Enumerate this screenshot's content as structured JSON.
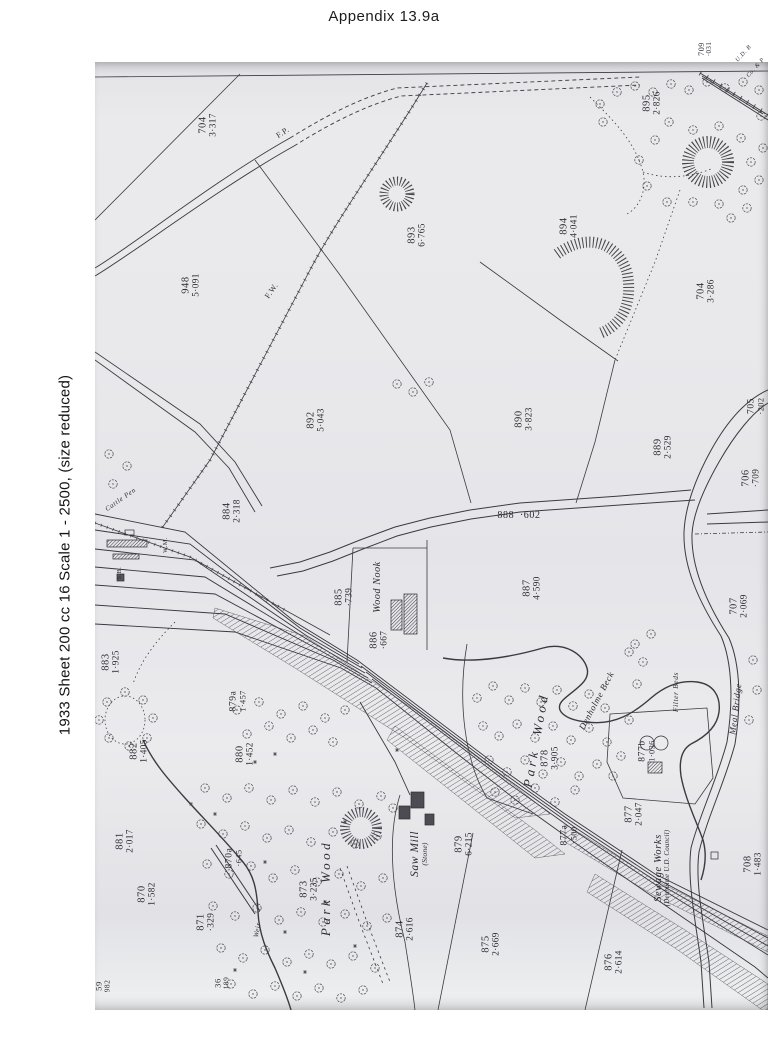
{
  "page": {
    "title": "Appendix  13.9a",
    "caption": "1933 Sheet 200 cc 16 Scale 1 - 2500, (size reduced)"
  },
  "colors": {
    "page_bg": "#ffffff",
    "paper": "#e9e9ec",
    "ink": "#35353b",
    "label_ink": "#2c2c33"
  },
  "map": {
    "parcel_labels": [
      {
        "number": "704",
        "acreage": "3·317",
        "x": 208,
        "y": 125
      },
      {
        "number": "709",
        "acreage": "·031",
        "x": 706,
        "y": 49,
        "size": 8
      },
      {
        "number": "895",
        "acreage": "2·826",
        "x": 652,
        "y": 103
      },
      {
        "number": "948",
        "acreage": "5·091",
        "x": 191,
        "y": 285
      },
      {
        "number": "893",
        "acreage": "6·765",
        "x": 417,
        "y": 235
      },
      {
        "number": "894",
        "acreage": "4·041",
        "x": 569,
        "y": 226
      },
      {
        "number": "704",
        "acreage": "3·286",
        "x": 706,
        "y": 291
      },
      {
        "number": "892",
        "acreage": "5·043",
        "x": 316,
        "y": 420
      },
      {
        "number": "890",
        "acreage": "3·823",
        "x": 524,
        "y": 419
      },
      {
        "number": "889",
        "acreage": "2·529",
        "x": 663,
        "y": 447
      },
      {
        "number": "884",
        "acreage": "2·318",
        "x": 232,
        "y": 511
      },
      {
        "number": "888",
        "acreage": "·602",
        "x": 519,
        "y": 516,
        "rot": 0,
        "inline": true,
        "size": 10
      },
      {
        "number": "887",
        "acreage": "4·590",
        "x": 532,
        "y": 588
      },
      {
        "number": "885",
        "acreage": "·739",
        "x": 344,
        "y": 597
      },
      {
        "number": "886",
        "acreage": "·667",
        "x": 379,
        "y": 640
      },
      {
        "number": "883",
        "acreage": "1·925",
        "x": 111,
        "y": 662
      },
      {
        "number": "879a",
        "acreage": "1·457",
        "x": 239,
        "y": 701,
        "size": 9.5
      },
      {
        "number": "882",
        "acreage": "1·405",
        "x": 139,
        "y": 751
      },
      {
        "number": "880",
        "acreage": "1·452",
        "x": 245,
        "y": 754
      },
      {
        "number": "881",
        "acreage": "2·017",
        "x": 125,
        "y": 841
      },
      {
        "number": "870a",
        "acreage": "·645",
        "x": 235,
        "y": 858,
        "size": 9.5
      },
      {
        "number": "870",
        "acreage": "1·582",
        "x": 147,
        "y": 894
      },
      {
        "number": "871",
        "acreage": "·329",
        "x": 206,
        "y": 922
      },
      {
        "number": "873",
        "acreage": "3·235",
        "x": 309,
        "y": 889
      },
      {
        "number": "874",
        "acreage": "2·616",
        "x": 405,
        "y": 929
      },
      {
        "number": "875",
        "acreage": "2·669",
        "x": 491,
        "y": 944
      },
      {
        "number": "876",
        "acreage": "2·614",
        "x": 614,
        "y": 962
      },
      {
        "number": "879",
        "acreage": "6·215",
        "x": 464,
        "y": 844
      },
      {
        "number": "877",
        "acreage": "2·047",
        "x": 634,
        "y": 814
      },
      {
        "number": "877a",
        "acreage": "·500",
        "x": 570,
        "y": 835,
        "size": 9.5
      },
      {
        "number": "877b",
        "acreage": "1·036",
        "x": 648,
        "y": 751,
        "size": 9.5
      },
      {
        "number": "878",
        "acreage": "3·905",
        "x": 550,
        "y": 758
      },
      {
        "number": "705",
        "acreage": "·202",
        "x": 757,
        "y": 406,
        "size": 9.5
      },
      {
        "number": "706",
        "acreage": "·709",
        "x": 751,
        "y": 478
      },
      {
        "number": "707",
        "acreage": "2·069",
        "x": 739,
        "y": 606
      },
      {
        "number": "708",
        "acreage": "1·483",
        "x": 753,
        "y": 864
      },
      {
        "number": "59",
        "acreage": "982",
        "x": 103,
        "y": 986,
        "size": 8.5
      },
      {
        "number": "36",
        "acreage": "189",
        "x": 222,
        "y": 983,
        "size": 8.5
      }
    ],
    "place_labels": [
      {
        "text": "Wood Nook",
        "x": 378,
        "y": 587,
        "rot": -90,
        "size": 10
      },
      {
        "lines": [
          "Saw Mill",
          "(Stone)"
        ],
        "x": 419,
        "y": 854,
        "rot": -90,
        "size": 11.5
      },
      {
        "text": "Park Wood",
        "x": 326,
        "y": 888,
        "rot": -90,
        "size": 13,
        "spread": true
      },
      {
        "text": "Park Wood",
        "x": 536,
        "y": 740,
        "rot": -80,
        "size": 13,
        "spread": true
      },
      {
        "lines": [
          "Sewage Works",
          "(Denholme U.D. Council)"
        ],
        "x": 662,
        "y": 868,
        "rot": -90,
        "size": 10.5
      },
      {
        "text": "Denholme Beck",
        "x": 597,
        "y": 701,
        "rot": -62,
        "size": 9
      },
      {
        "text": "Filter Beds",
        "x": 676,
        "y": 692,
        "rot": -90,
        "size": 7.5
      },
      {
        "text": "Meal Bridge",
        "x": 736,
        "y": 709,
        "rot": -83,
        "size": 9
      },
      {
        "text": "Cattle Pen",
        "x": 121,
        "y": 500,
        "rot": -35,
        "size": 7
      },
      {
        "text": "Weir",
        "x": 258,
        "y": 930,
        "rot": -80,
        "size": 7
      },
      {
        "text": "F.W.",
        "x": 272,
        "y": 291,
        "rot": -55,
        "size": 8,
        "italic": false
      },
      {
        "text": "F.P.",
        "x": 283,
        "y": 133,
        "rot": -33,
        "size": 8,
        "italic": false
      },
      {
        "text": "S.B.",
        "x": 120,
        "y": 573,
        "rot": -90,
        "size": 6,
        "italic": false
      },
      {
        "text": "W.M.",
        "x": 166,
        "y": 545,
        "rot": -90,
        "size": 6,
        "italic": false
      },
      {
        "text": "U.D. B",
        "x": 744,
        "y": 54,
        "rot": -48,
        "size": 6
      },
      {
        "text": "Co. & P",
        "x": 756,
        "y": 68,
        "rot": -48,
        "size": 6
      }
    ]
  }
}
